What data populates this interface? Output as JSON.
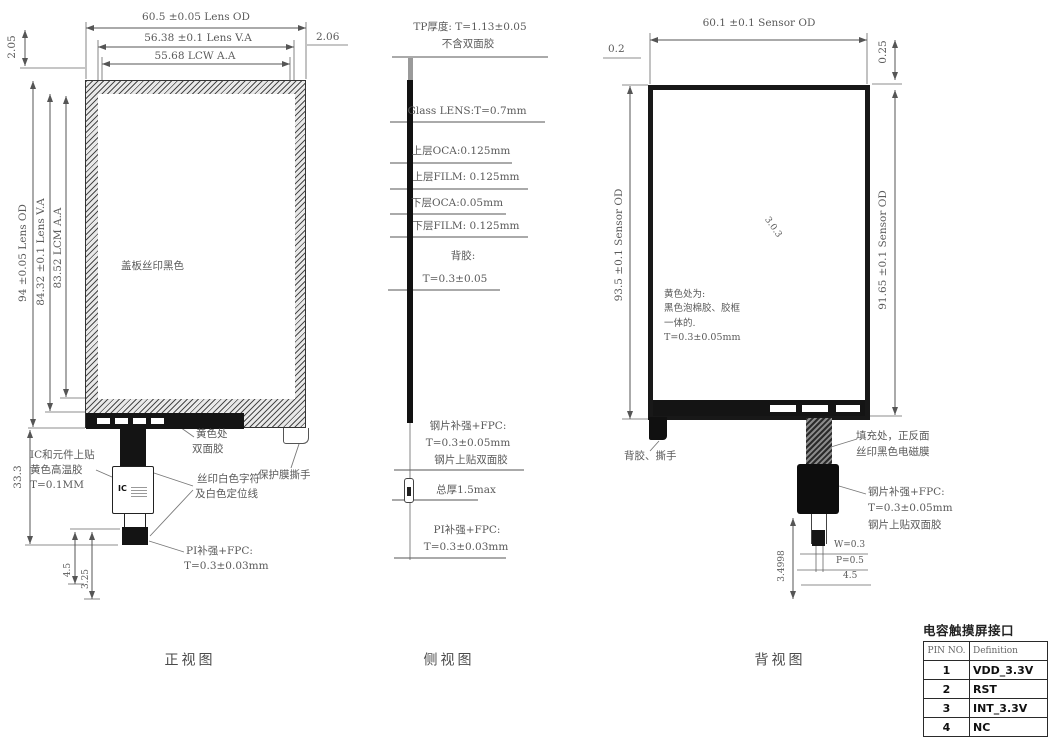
{
  "front": {
    "view_label": "正视图",
    "dim_top_od": "60.5 ±0.05 Lens OD",
    "dim_top_va": "56.38 ±0.1 Lens V.A",
    "dim_top_aa": "55.68 LCW A.A",
    "dim_top_right": "2.06",
    "dim_top_left": "2.05",
    "dim_left_od": "94 ±0.05 Lens OD",
    "dim_left_va": "84.32 ±0.1 Lens V.A",
    "dim_left_aa": "83.52 LCM A.A",
    "dim_tail_height": "33.3",
    "dim_tail_a": "4.5",
    "dim_tail_b": "3.25",
    "note_cover": "盖板丝印黑色",
    "note_tape_1": "黄色处",
    "note_tape_2": "双面胶",
    "note_ic_1": "IC和元件上贴",
    "note_ic_2": "黄色高温胶",
    "note_ic_3": "T=0.1MM",
    "note_silk_1": "丝印白色字符",
    "note_silk_2": "及白色定位线",
    "note_film": "保护膜撕手",
    "note_pi_1": "PI补强+FPC:",
    "note_pi_2": "T=0.3±0.03mm",
    "ic_text": "IC"
  },
  "side": {
    "view_label": "侧视图",
    "tp_1": "TP厚度: T=1.13±0.05",
    "tp_2": "不含双面胶",
    "glass": "Glass LENS:T=0.7mm",
    "oca_top": "上层OCA:0.125mm",
    "film_top": "上层FILM: 0.125mm",
    "oca_bot": "下层OCA:0.05mm",
    "film_bot": "下层FILM: 0.125mm",
    "adhesive_1": "背胶:",
    "adhesive_2": "T=0.3±0.05",
    "steel_1": "钢片补强+FPC:",
    "steel_2": "T=0.3±0.05mm",
    "steel_3": "钢片上贴双面胶",
    "total": "总厚1.5max",
    "pi_1": "PI补强+FPC:",
    "pi_2": "T=0.3±0.03mm"
  },
  "back": {
    "view_label": "背视图",
    "dim_top": "60.1 ±0.1 Sensor OD",
    "dim_top_left": "0.2",
    "dim_top_right": "0.25",
    "dim_left": "93.5 ±0.1 Sensor OD",
    "dim_right": "91.65 ±0.1 Sensor OD",
    "diag_label": "3.0.3",
    "note_foam_1": "黄色处为:",
    "note_foam_2": "黑色泡棉胶、胶框",
    "note_foam_3": "一体的.",
    "note_foam_4": "T=0.3±0.05mm",
    "note_tear": "背胶、撕手",
    "note_fill_1": "填充处，正反面",
    "note_fill_2": "丝印黑色电磁膜",
    "note_steel_1": "钢片补强+FPC:",
    "note_steel_2": "T=0.3±0.05mm",
    "note_steel_3": "钢片上贴双面胶",
    "dim_w": "W=0.3",
    "dim_p": "P=0.5",
    "dim_45": "4.5",
    "dim_len": "3.4998"
  },
  "pin_table": {
    "title": "电容触摸屏接口",
    "headers": [
      "PIN NO.",
      "Definition"
    ],
    "rows": [
      {
        "pin": "1",
        "def": "VDD_3.3V"
      },
      {
        "pin": "2",
        "def": "RST"
      },
      {
        "pin": "3",
        "def": "INT_3.3V"
      },
      {
        "pin": "4",
        "def": "NC"
      }
    ]
  },
  "colors": {
    "line": "#555555",
    "ink": "#3a3a3a",
    "fill_black": "#141414"
  }
}
